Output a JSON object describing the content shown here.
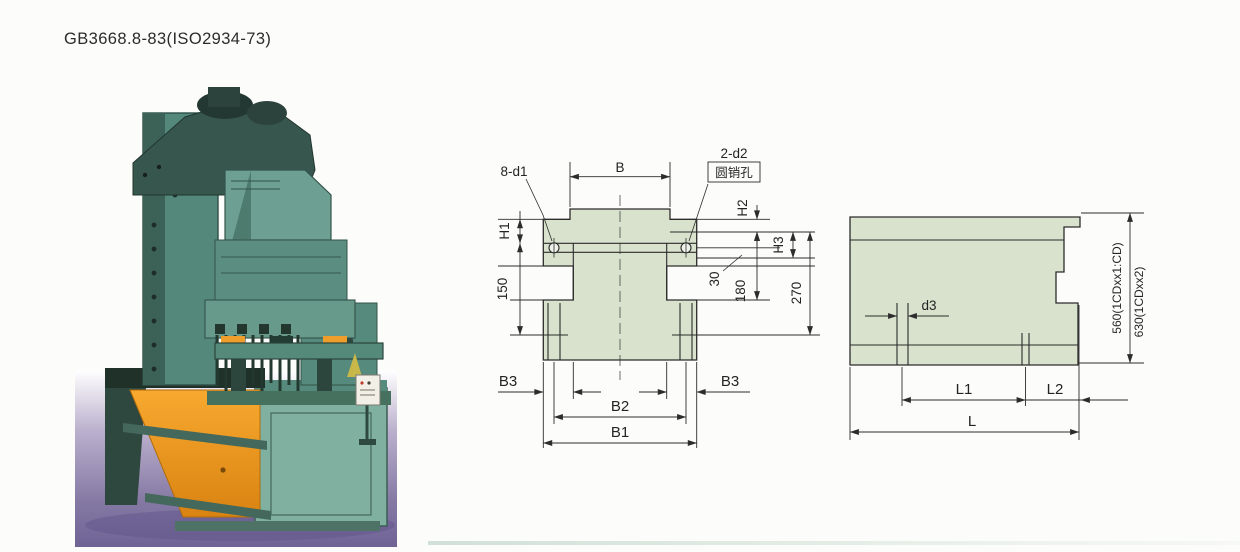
{
  "page": {
    "title": "GB3668.8-83(ISO2934-73)"
  },
  "photo": {
    "subject": "modular machine tool side-bed press, front-left view",
    "machine_color": "#53887b",
    "head_color": "#37564e",
    "chute_color": "#f2a02c",
    "floor_color": "#8478a3"
  },
  "front_view": {
    "fill_color": "#d8e2cd",
    "line_color": "#2c2c2c",
    "labels": {
      "width_b": "B",
      "holes_top": "8-d1",
      "holes_pin": "2-d2",
      "pin_hole_note": "圆销孔",
      "h1": "H1",
      "h2": "H2",
      "h3": "H3",
      "dim_150": "150",
      "dim_30": "30",
      "dim_180": "180",
      "dim_270": "270",
      "b3_left": "B3",
      "b3_right": "B3",
      "b2": "B2",
      "b1": "B1"
    }
  },
  "side_view": {
    "fill_color": "#d8e2cd",
    "labels": {
      "d3": "d3",
      "l1": "L1",
      "l2": "L2",
      "l": "L",
      "height_primary": "560(1CDxx1:CD)",
      "height_secondary": "630(1CDxx2)"
    }
  }
}
